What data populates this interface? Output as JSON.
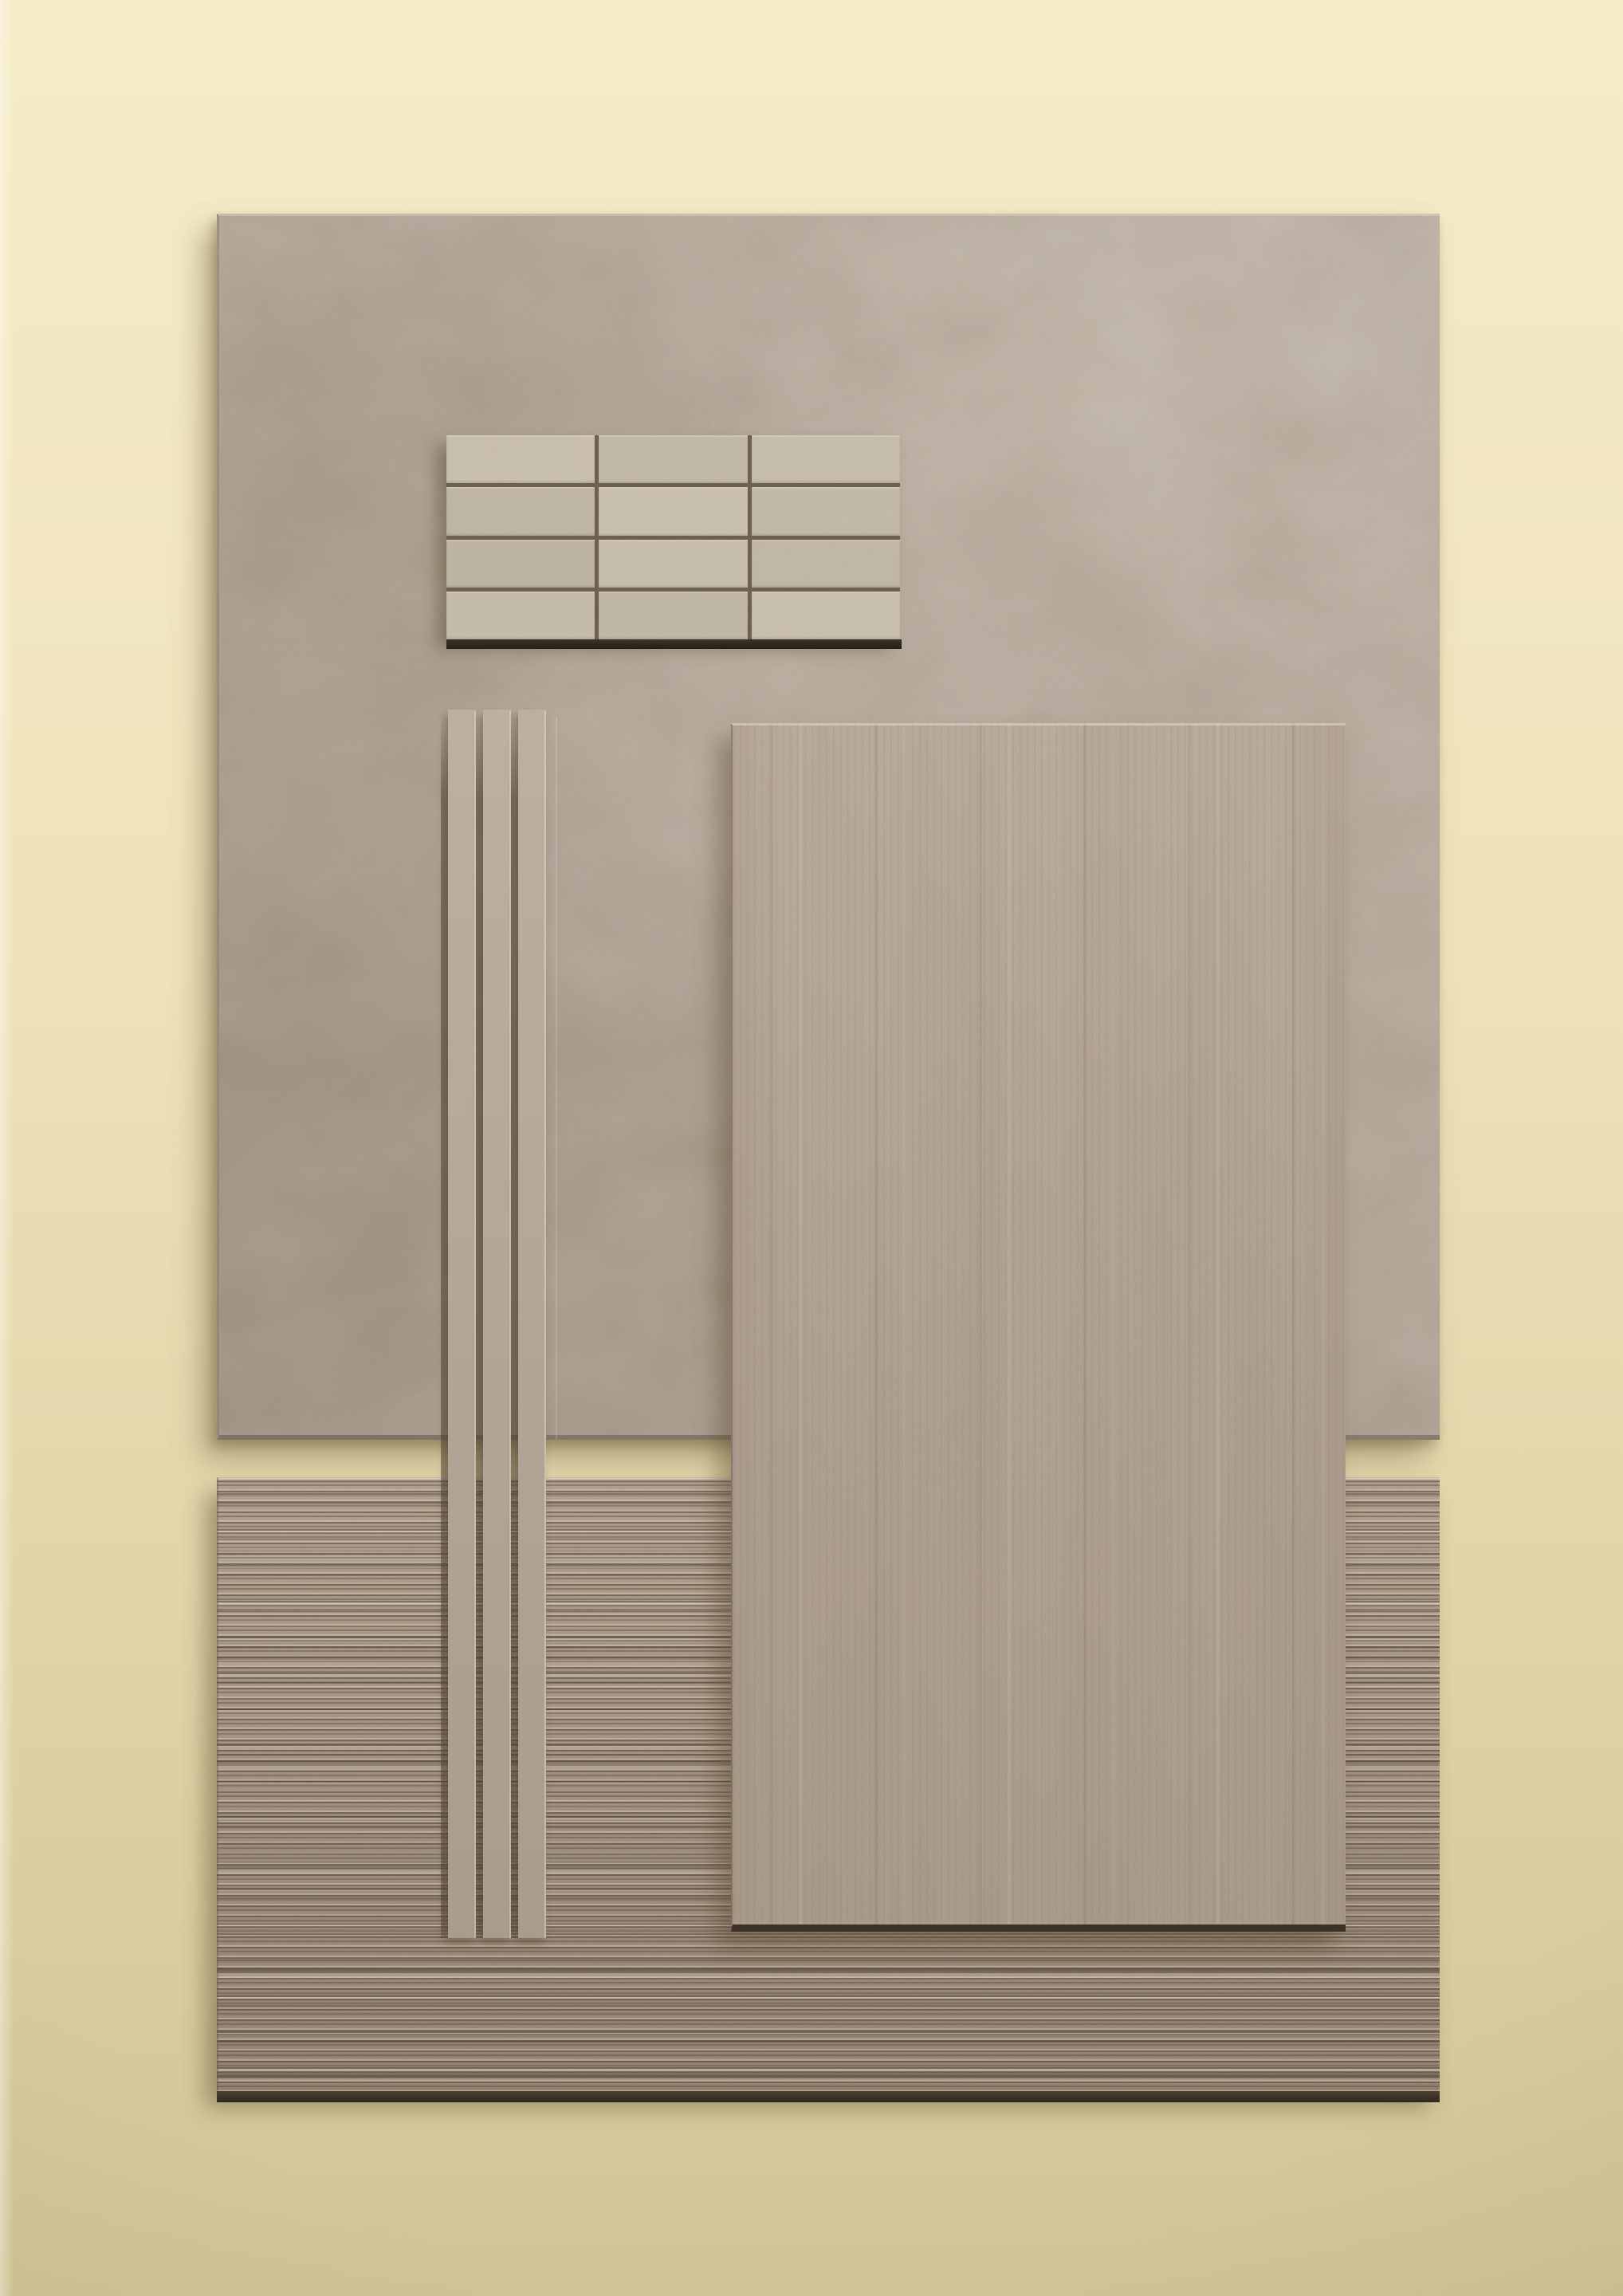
{
  "scene": {
    "type": "product-photograph",
    "objects": [
      {
        "id": "backdrop",
        "label": "cream seamless backdrop"
      },
      {
        "id": "large-stone-panel",
        "label": "large square limestone-look slab"
      },
      {
        "id": "brick-mosaic-sample",
        "label": "stacked brick mosaic sheet"
      },
      {
        "id": "pencil-trim-strips",
        "label": "narrow pencil trim strips"
      },
      {
        "id": "veined-field-tile",
        "label": "vertically veined rectangular field tile"
      },
      {
        "id": "fluted-relief-panel",
        "label": "horizontally fluted 3D relief panel"
      }
    ]
  },
  "mosaic": {
    "rows": 4,
    "columns": 3,
    "tile_shades": [
      "#cbc1b1",
      "#c5bbab",
      "#c9bfaf",
      "#c2b8a8",
      "#cdc3b3",
      "#c6bcac",
      "#c1b7a7",
      "#cac0b0",
      "#c4baaa",
      "#c8beae",
      "#c3b9a9",
      "#ccc2b2"
    ]
  },
  "trim_strips": {
    "count": 3
  },
  "colors": {
    "bg_top": "#f5ecc8",
    "bg_mid": "#eee2ba",
    "bg_bottom": "#d1c494",
    "panel_light": "#c2b7aa",
    "panel_base": "#b5a99b",
    "panel_dark": "#a49788",
    "mosaic_grout": "#6e6254",
    "mosaic_edge_dark": "#261f18",
    "strip_base": "#b3a698",
    "field_light": "#beb0a2",
    "field_base": "#b6a89a",
    "field_dark": "#aea08f",
    "field_edge_dark": "#3a3128",
    "ribbed_light": "#b3a290",
    "ribbed_base": "#a39281",
    "ribbed_dark": "#968573",
    "ribbed_edge_dark": "#2e2720"
  }
}
